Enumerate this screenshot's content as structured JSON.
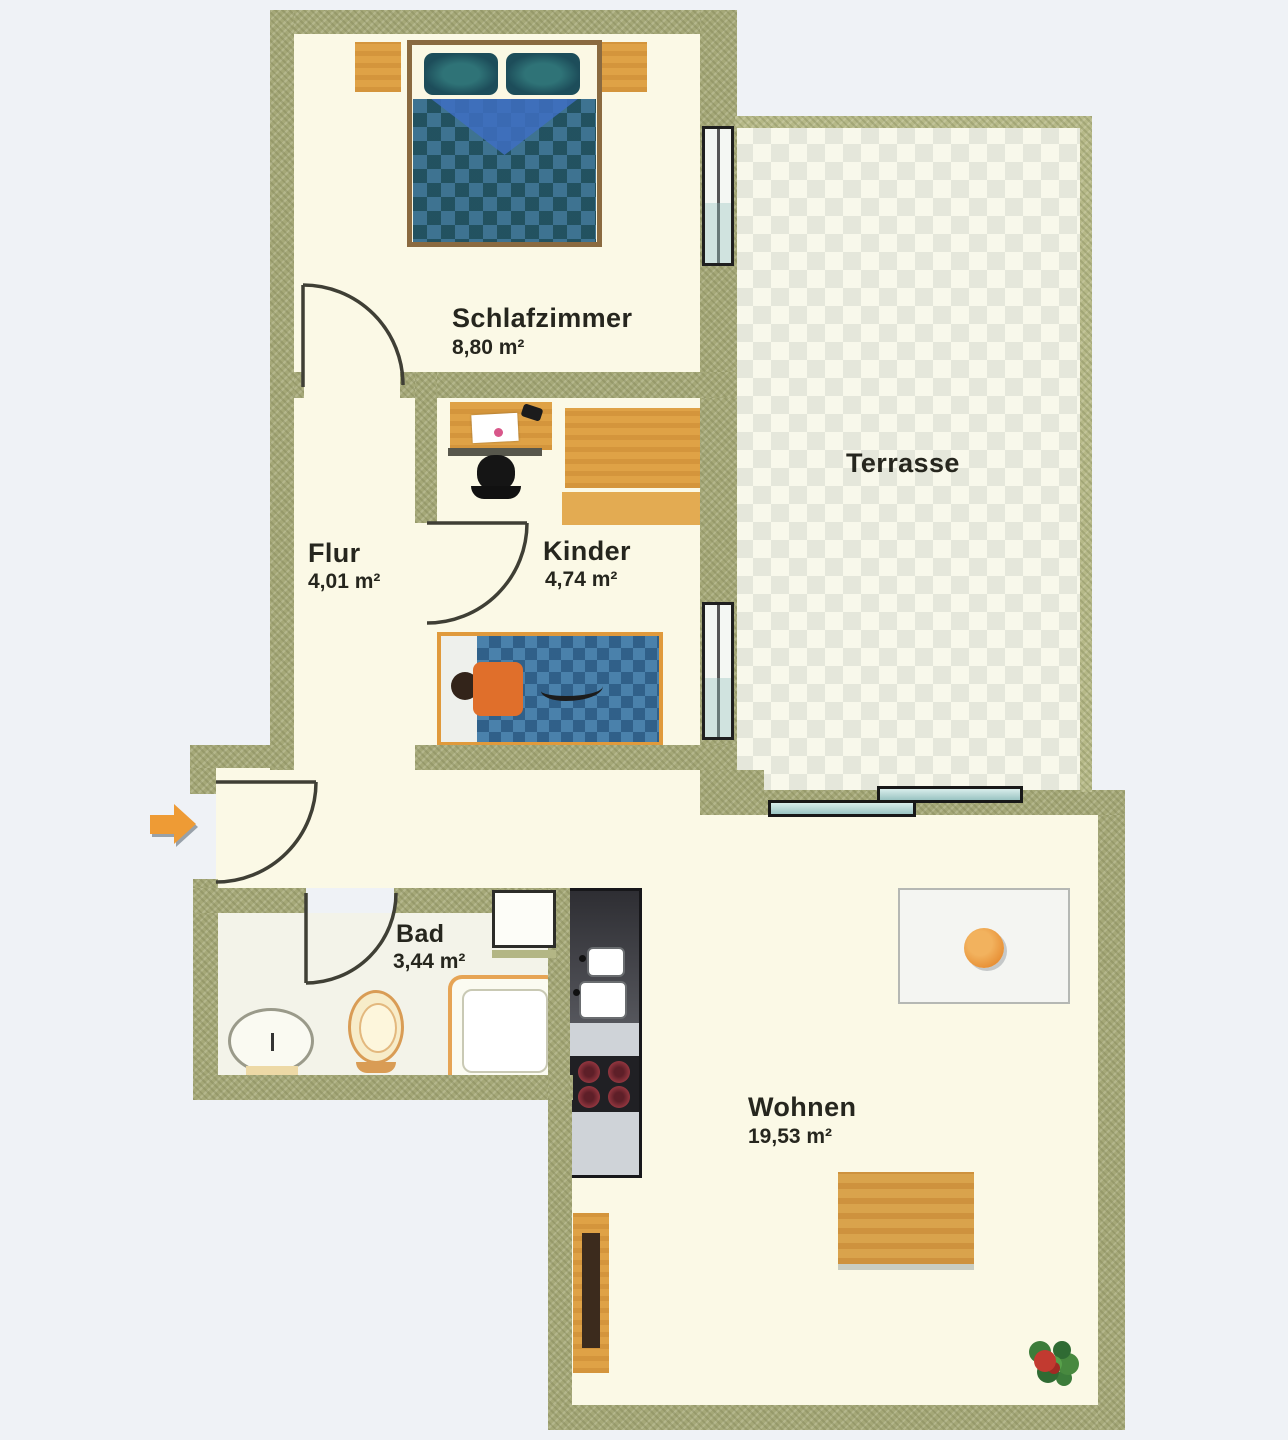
{
  "page": {
    "background": "#eff2f6"
  },
  "plan": {
    "wall_color": "#a5a878",
    "floor_color": "#fbf9e6",
    "accent_wood_color": "#dfa246",
    "sofa_color": "#56262b",
    "bed_blanket_color": "#3e7391",
    "rooms": [
      {
        "name": "Schlafzimmer",
        "area": "8,80 m²"
      },
      {
        "name": "Flur",
        "area": "4,01 m²"
      },
      {
        "name": "Kinder",
        "area": "4,74 m²"
      },
      {
        "name": "Terrasse",
        "area": ""
      },
      {
        "name": "Bad",
        "area": "3,44 m²"
      },
      {
        "name": "Wohnen",
        "area": "19,53 m²"
      }
    ],
    "symbols": [
      "entry-arrow",
      "door-swing",
      "window",
      "sliding-door",
      "double-bed",
      "nightstand",
      "wardrobe",
      "desk",
      "desk-chair",
      "child-bed",
      "dining-table",
      "dining-chair",
      "fruit-bowl",
      "kitchenette",
      "sink-basin",
      "stove-burners",
      "shower-tray",
      "toilet",
      "washbasin",
      "bathtub",
      "sideboard",
      "rug",
      "sofa",
      "plant"
    ]
  }
}
